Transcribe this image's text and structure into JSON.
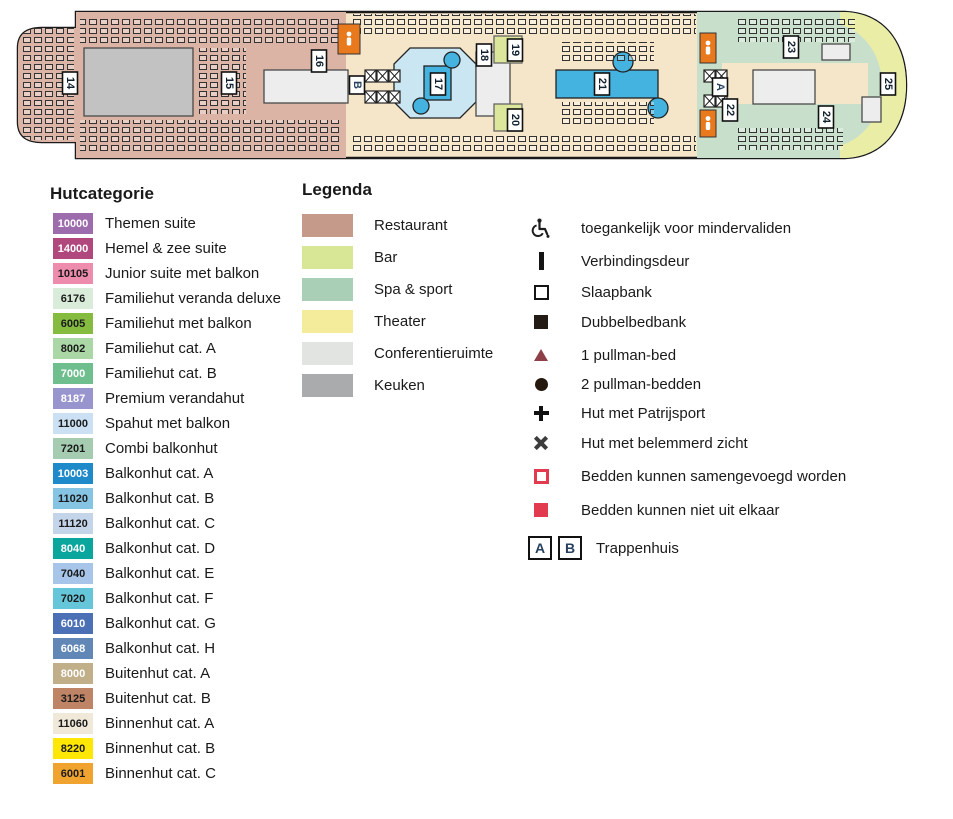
{
  "ship": {
    "palette": {
      "deck": "#F6E6C9",
      "restaurant": "#DBB4A6",
      "spa": "#C8E0CB",
      "sun_deck": "#EAEDA5",
      "pool": "#45B3DF",
      "pool_deck": "#CBE6F3",
      "bar": "#DDE79B",
      "kitchen": "#C2C2C2",
      "block": "#EDEDED",
      "toilet": "#E8791D"
    },
    "zones": [
      {
        "type": "rect",
        "name": "restaurant-area",
        "x": 16,
        "y": 10,
        "w": 330,
        "h": 150,
        "fill": "#DBB4A6"
      },
      {
        "type": "rect",
        "name": "kitchen-block",
        "x": 84,
        "y": 48,
        "w": 109,
        "h": 68,
        "fill": "#C2C2C2",
        "stroke": "#4a4a4a"
      },
      {
        "type": "rect",
        "name": "theater-stage-block",
        "x": 264,
        "y": 70,
        "w": 84,
        "h": 33,
        "fill": "#EDEDED",
        "stroke": "#4a4a4a"
      },
      {
        "type": "rect",
        "name": "spa-area",
        "x": 697,
        "y": 10,
        "w": 215,
        "h": 150,
        "fill": "#C8E0CB"
      },
      {
        "type": "rect",
        "name": "bow-sun-deck",
        "x": 840,
        "y": 10,
        "w": 70,
        "h": 150,
        "fill": "#EAEDA5"
      },
      {
        "type": "ellipse",
        "name": "spa-inner-area",
        "cx": 828,
        "cy": 85,
        "rx": 54,
        "ry": 62,
        "fill": "#C8E0CB"
      },
      {
        "type": "rect",
        "name": "spa-corridor",
        "x": 722,
        "y": 63,
        "w": 146,
        "h": 41,
        "fill": "#F6E6C9"
      },
      {
        "type": "rect",
        "name": "spa-block-1",
        "x": 753,
        "y": 70,
        "w": 62,
        "h": 34,
        "fill": "#EDEDED",
        "stroke": "#4a4a4a"
      },
      {
        "type": "rect",
        "name": "spa-block-2",
        "x": 822,
        "y": 44,
        "w": 28,
        "h": 16,
        "fill": "#EDEDED",
        "stroke": "#4a4a4a"
      },
      {
        "type": "rect",
        "name": "spa-block-3",
        "x": 862,
        "y": 97,
        "w": 19,
        "h": 25,
        "fill": "#EDEDED",
        "stroke": "#4a4a4a"
      },
      {
        "type": "poly",
        "name": "pool-17-deck",
        "points": "410,48 460,48 476,64 476,102 460,118 410,118 394,102 394,64",
        "fill": "#CBE6F3",
        "stroke": "#222"
      },
      {
        "type": "rect",
        "name": "pool-17",
        "x": 424,
        "y": 66,
        "w": 27,
        "h": 34,
        "fill": "#45B3DF",
        "stroke": "#222"
      },
      {
        "type": "circle",
        "name": "pool-17-whirlpool-1",
        "cx": 452,
        "cy": 60,
        "r": 8,
        "fill": "#45B3DF",
        "stroke": "#222"
      },
      {
        "type": "circle",
        "name": "pool-17-whirlpool-2",
        "cx": 421,
        "cy": 106,
        "r": 8,
        "fill": "#45B3DF",
        "stroke": "#222"
      },
      {
        "type": "rect",
        "name": "block-right-of-pool-17",
        "x": 476,
        "y": 52,
        "w": 34,
        "h": 64,
        "fill": "#EDEDED",
        "stroke": "#4a4a4a"
      },
      {
        "type": "rect",
        "name": "bar-block-top",
        "x": 494,
        "y": 36,
        "w": 28,
        "h": 27,
        "fill": "#DDE79B",
        "stroke": "#666"
      },
      {
        "type": "rect",
        "name": "bar-block-bottom",
        "x": 494,
        "y": 104,
        "w": 28,
        "h": 27,
        "fill": "#DDE79B",
        "stroke": "#666"
      },
      {
        "type": "rect",
        "name": "pool-21",
        "x": 556,
        "y": 70,
        "w": 102,
        "h": 28,
        "fill": "#45B3DF",
        "stroke": "#222"
      },
      {
        "type": "circle",
        "name": "pool-21-whirlpool-1",
        "cx": 623,
        "cy": 62,
        "r": 10,
        "fill": "#45B3DF",
        "stroke": "#222"
      },
      {
        "type": "circle",
        "name": "pool-21-whirlpool-2",
        "cx": 658,
        "cy": 108,
        "r": 10,
        "fill": "#45B3DF",
        "stroke": "#222"
      }
    ],
    "furniture": [
      [
        22,
        28,
        52,
        112
      ],
      [
        80,
        16,
        262,
        28
      ],
      [
        80,
        120,
        262,
        34
      ],
      [
        196,
        48,
        50,
        66
      ],
      [
        352,
        14,
        344,
        20
      ],
      [
        352,
        136,
        344,
        18
      ],
      [
        560,
        42,
        94,
        22
      ],
      [
        560,
        102,
        94,
        24
      ],
      [
        735,
        16,
        120,
        26
      ],
      [
        735,
        128,
        108,
        22
      ]
    ],
    "elevators": [
      [
        365,
        70
      ],
      [
        377,
        70
      ],
      [
        389,
        70
      ],
      [
        365,
        91
      ],
      [
        377,
        91
      ],
      [
        389,
        91
      ],
      [
        704,
        70
      ],
      [
        716,
        70
      ],
      [
        704,
        95
      ],
      [
        716,
        95
      ]
    ],
    "toilets": [
      {
        "x": 338,
        "y": 24,
        "w": 22,
        "h": 30
      },
      {
        "x": 700,
        "y": 33,
        "w": 16,
        "h": 30
      },
      {
        "x": 700,
        "y": 110,
        "w": 16,
        "h": 27
      }
    ],
    "markers": [
      {
        "cx": 70,
        "cy": 83,
        "label": "14",
        "kind": "num"
      },
      {
        "cx": 229,
        "cy": 83,
        "label": "15",
        "kind": "num"
      },
      {
        "cx": 319,
        "cy": 61,
        "label": "16",
        "kind": "num"
      },
      {
        "cx": 357,
        "cy": 85,
        "label": "B",
        "kind": "stair"
      },
      {
        "cx": 438,
        "cy": 84,
        "label": "17",
        "kind": "num"
      },
      {
        "cx": 484,
        "cy": 55,
        "label": "18",
        "kind": "num"
      },
      {
        "cx": 515,
        "cy": 50,
        "label": "19",
        "kind": "num"
      },
      {
        "cx": 515,
        "cy": 120,
        "label": "20",
        "kind": "num"
      },
      {
        "cx": 602,
        "cy": 84,
        "label": "21",
        "kind": "num"
      },
      {
        "cx": 720,
        "cy": 87,
        "label": "A",
        "kind": "stair"
      },
      {
        "cx": 730,
        "cy": 110,
        "label": "22",
        "kind": "num"
      },
      {
        "cx": 791,
        "cy": 47,
        "label": "23",
        "kind": "num"
      },
      {
        "cx": 826,
        "cy": 117,
        "label": "24",
        "kind": "num"
      },
      {
        "cx": 888,
        "cy": 84,
        "label": "25",
        "kind": "num"
      }
    ]
  },
  "hutcategorie": {
    "title": "Hutcategorie",
    "items": [
      {
        "code": "10000",
        "label": "Themen suite",
        "color": "#9D6CAD",
        "text": "#ffffff"
      },
      {
        "code": "14000",
        "label": "Hemel & zee suite",
        "color": "#B0487D",
        "text": "#ffffff"
      },
      {
        "code": "10105",
        "label": "Junior suite met balkon",
        "color": "#EE8CAD",
        "text": "#1a1a1a"
      },
      {
        "code": "6176",
        "label": "Familiehut veranda deluxe",
        "color": "#D9ECDA",
        "text": "#1a1a1a"
      },
      {
        "code": "6005",
        "label": "Familiehut met balkon",
        "color": "#85BC40",
        "text": "#1a1a1a"
      },
      {
        "code": "8002",
        "label": "Familiehut cat. A",
        "color": "#ABD7A6",
        "text": "#1a1a1a"
      },
      {
        "code": "7000",
        "label": "Familiehut cat. B",
        "color": "#6FBF8E",
        "text": "#ffffff"
      },
      {
        "code": "8187",
        "label": "Premium verandahut",
        "color": "#9894CE",
        "text": "#ffffff"
      },
      {
        "code": "11000",
        "label": "Spahut met balkon",
        "color": "#CBE0F3",
        "text": "#1a1a1a"
      },
      {
        "code": "7201",
        "label": "Combi balkonhut",
        "color": "#A5CCB1",
        "text": "#1a1a1a"
      },
      {
        "code": "10003",
        "label": "Balkonhut cat. A",
        "color": "#1F8AC9",
        "text": "#ffffff"
      },
      {
        "code": "11020",
        "label": "Balkonhut cat. B",
        "color": "#86C4E4",
        "text": "#1a1a1a"
      },
      {
        "code": "11120",
        "label": "Balkonhut cat. C",
        "color": "#C5D5E9",
        "text": "#1a1a1a"
      },
      {
        "code": "8040",
        "label": "Balkonhut cat. D",
        "color": "#0AA69E",
        "text": "#ffffff"
      },
      {
        "code": "7040",
        "label": "Balkonhut cat. E",
        "color": "#A6C5E9",
        "text": "#1a1a1a"
      },
      {
        "code": "7020",
        "label": "Balkonhut cat. F",
        "color": "#66C6D9",
        "text": "#1a1a1a"
      },
      {
        "code": "6010",
        "label": "Balkonhut cat. G",
        "color": "#4C70B6",
        "text": "#ffffff"
      },
      {
        "code": "6068",
        "label": "Balkonhut cat. H",
        "color": "#6187B6",
        "text": "#ffffff"
      },
      {
        "code": "8000",
        "label": "Buitenhut cat. A",
        "color": "#C0AF89",
        "text": "#ffffff"
      },
      {
        "code": "3125",
        "label": "Buitenhut cat. B",
        "color": "#BF8365",
        "text": "#1a1a1a"
      },
      {
        "code": "11060",
        "label": "Binnenhut cat. A",
        "color": "#F0E9D9",
        "text": "#1a1a1a"
      },
      {
        "code": "8220",
        "label": "Binnenhut cat. B",
        "color": "#FFE705",
        "text": "#1a1a1a"
      },
      {
        "code": "6001",
        "label": "Binnenhut cat. C",
        "color": "#F0A32E",
        "text": "#1a1a1a"
      }
    ]
  },
  "legenda": {
    "title": "Legenda",
    "colors": [
      {
        "label": "Restaurant",
        "color": "#C59A8B"
      },
      {
        "label": "Bar",
        "color": "#D8E795"
      },
      {
        "label": "Spa & sport",
        "color": "#A9CFB7"
      },
      {
        "label": "Theater",
        "color": "#F5EC9B"
      },
      {
        "label": "Conferentieruimte",
        "color": "#E2E4E2"
      },
      {
        "label": "Keuken",
        "color": "#A9ABAD"
      }
    ],
    "symbols": [
      {
        "icon": "wheelchair-icon",
        "label": "toegankelijk voor mindervaliden"
      },
      {
        "icon": "connecting-door-icon",
        "label": "Verbindingsdeur"
      },
      {
        "icon": "sofa-bed-icon",
        "label": "Slaapbank"
      },
      {
        "icon": "double-sofa-bed-icon",
        "label": "Dubbelbedbank"
      },
      {
        "icon": "one-pullman-icon",
        "label": "1 pullman-bed",
        "color": "#8E4049"
      },
      {
        "icon": "two-pullman-icon",
        "label": "2 pullman-bedden"
      },
      {
        "icon": "porthole-icon",
        "label": "Hut met Patrijsport"
      },
      {
        "icon": "obstructed-view-icon",
        "label": "Hut met belemmerd zicht"
      },
      {
        "icon": "beds-joinable-icon",
        "label": "Bedden kunnen samengevoegd worden",
        "color": "#E23B50"
      },
      {
        "icon": "beds-fixed-icon",
        "label": "Bedden kunnen niet uit elkaar",
        "color": "#E23B50"
      }
    ],
    "trappenhuis": {
      "letters": [
        "A",
        "B"
      ],
      "label": "Trappenhuis",
      "letter_color": "#27415E"
    }
  }
}
